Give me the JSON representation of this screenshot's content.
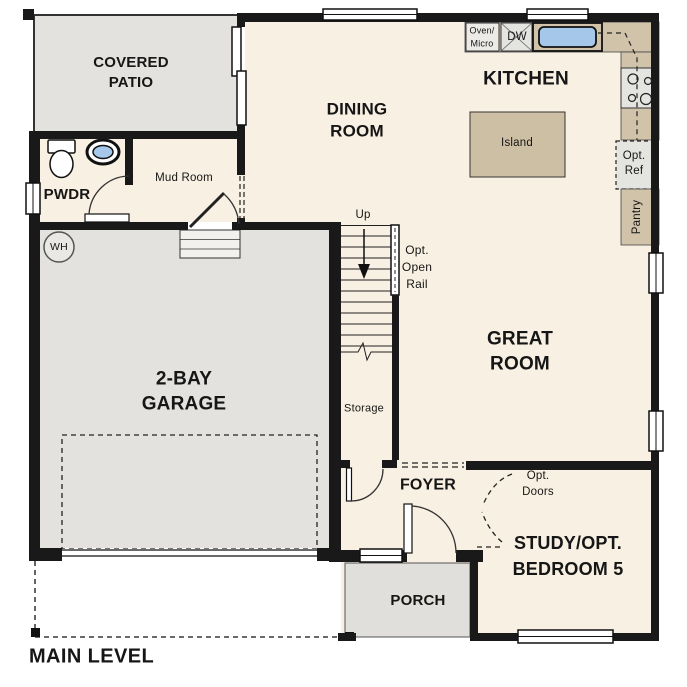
{
  "plan": {
    "level_label": "MAIN LEVEL",
    "rooms": {
      "covered_patio": "COVERED\nPATIO",
      "dining_room": "DINING\nROOM",
      "kitchen": "KITCHEN",
      "great_room": "GREAT\nROOM",
      "garage": "2-BAY\nGARAGE",
      "foyer": "FOYER",
      "study": "STUDY/OPT.\nBEDROOM 5",
      "porch": "PORCH",
      "powder": "PWDR",
      "mud_room": "Mud Room",
      "storage": "Storage"
    },
    "features": {
      "island": "Island",
      "oven_micro": "Oven/\nMicro",
      "dishwasher": "DW",
      "opt_ref": "Opt.\nRef",
      "pantry": "Pantry",
      "water_heater": "WH",
      "stairs_up": "Up",
      "opt_open_rail": "Opt.\nOpen\nRail",
      "opt_doors": "Opt.\nDoors"
    },
    "fixtures": [
      "toilet",
      "powder-sink",
      "kitchen-sink",
      "cooktop-burners",
      "water-heater",
      "stairs",
      "garage-door",
      "driveway-outline",
      "sliding-glass-door"
    ],
    "colors": {
      "floor": "#f8f0e2",
      "hard_surface": "#e3e2de",
      "porch": "#e0dfdb",
      "counter": "#d1c3aa",
      "appliance": "#e4e4e1",
      "sink_blue": "#a5c7e9",
      "wall": "#191919"
    }
  }
}
